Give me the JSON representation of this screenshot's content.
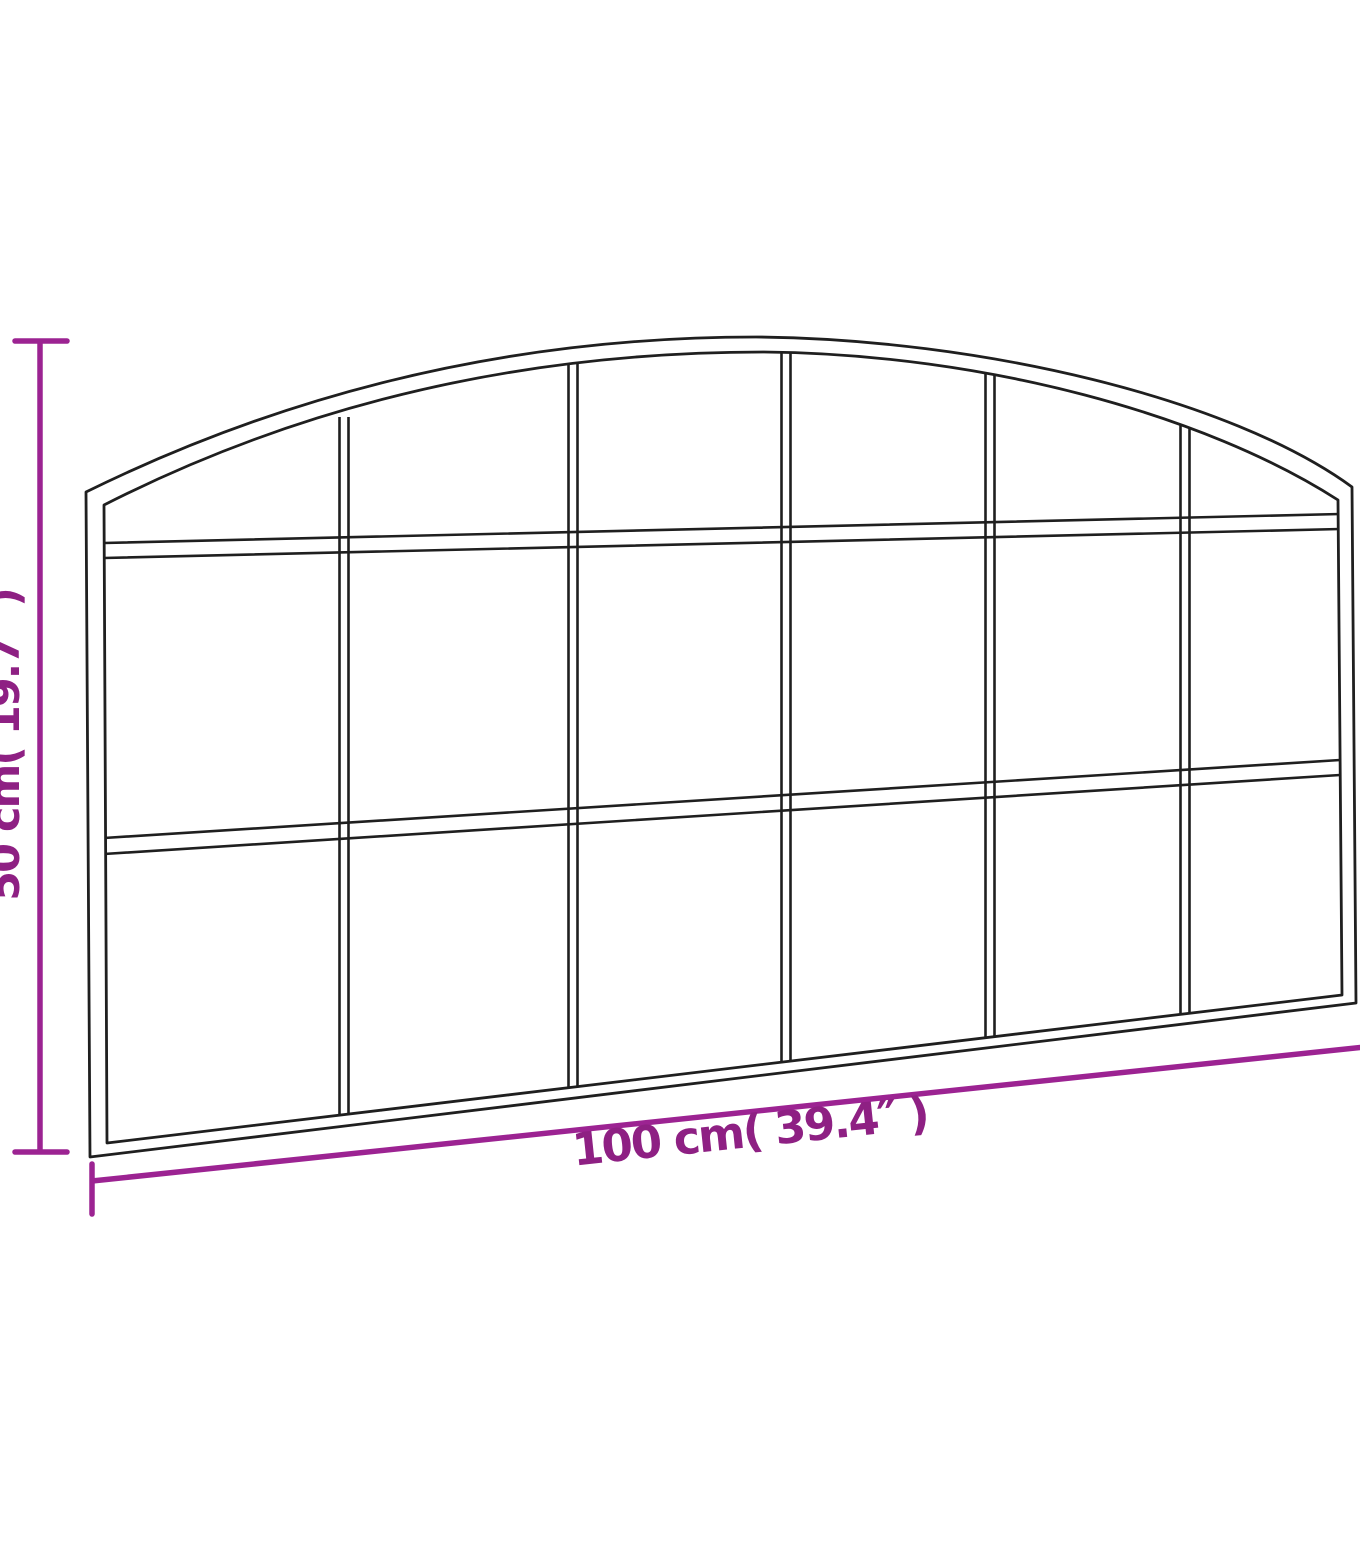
{
  "diagram": {
    "figure": "arched wall mirror with window-pane grid, shown in slight perspective with dimension annotations",
    "height_label": "50 cm( 19.7″ )",
    "width_label": "100 cm( 39.4″ )",
    "grid": {
      "columns": 6,
      "rows": 3,
      "panes": 18
    }
  },
  "colors": {
    "accent": "#8e2083",
    "accent_line": "#9c2392",
    "frame": "#1f1f1f",
    "background": "#ffffff"
  }
}
